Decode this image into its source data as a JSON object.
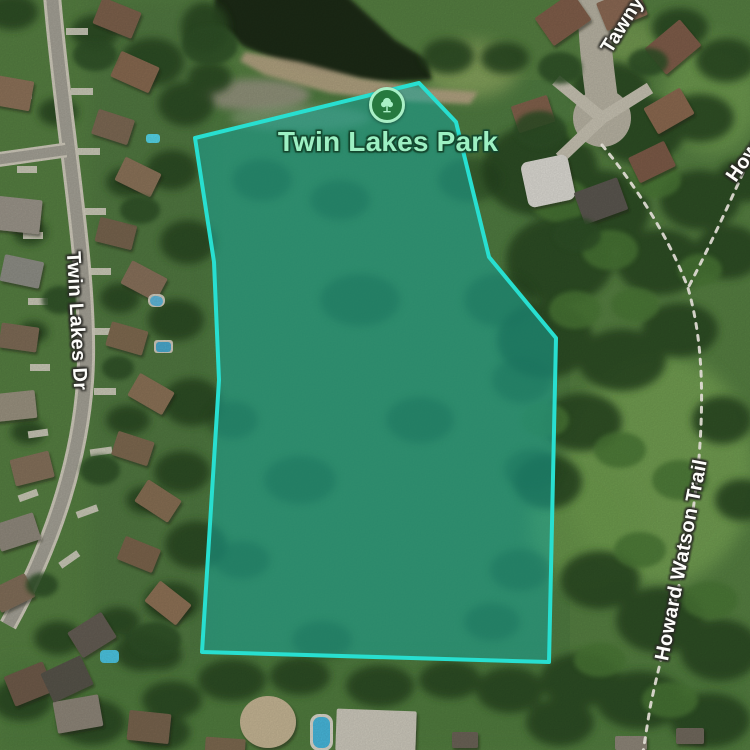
{
  "app": {
    "type": "satellite-map-view"
  },
  "park": {
    "name": "Twin Lakes Park",
    "marker_icon": "tree-icon",
    "label_color": "#9df0c3",
    "marker_ring_color": "#a9efc6",
    "marker_disc_color": "#26793f",
    "boundary_points": "195,138 419,83 456,122 489,257 556,338 549,662 202,652 219,380 214,262",
    "highlight_stroke": "#28dfd0",
    "highlight_fill": "#18a396",
    "highlight_fill_opacity": "0.55"
  },
  "streets": {
    "twin_lakes_dr": "Twin Lakes Dr",
    "tawny": "Tawny",
    "howard_watson_trail": "Howard Watson Trail",
    "howard": "Howard"
  }
}
